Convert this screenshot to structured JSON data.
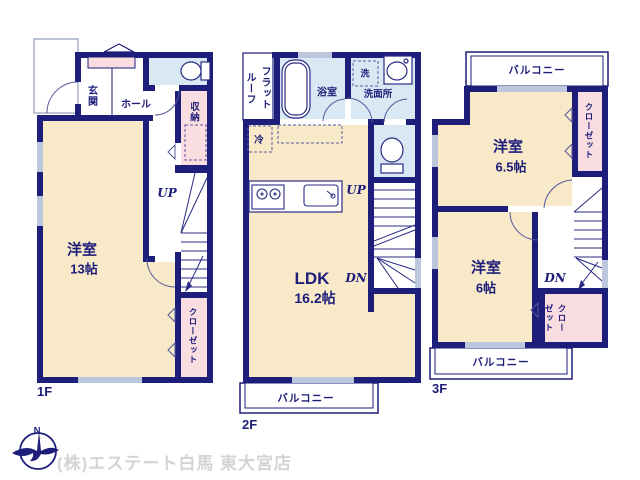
{
  "floor1": {
    "label": "1F",
    "entrance": "玄関",
    "hall": "ホール",
    "storage": "収納",
    "stairs_up": "UP",
    "room": "洋室",
    "room_size": "13帖",
    "closet": "クローゼット"
  },
  "floor2": {
    "label": "2F",
    "flat_roof": "フラットルーフ",
    "bath": "浴室",
    "laundry": "洗",
    "washroom": "洗面所",
    "fridge": "冷",
    "ldk": "LDK",
    "ldk_size": "16.2帖",
    "stairs_up": "UP",
    "stairs_down": "DN",
    "balcony": "バルコニー"
  },
  "floor3": {
    "label": "3F",
    "balcony_top": "バルコニー",
    "room1": "洋室",
    "room1_size": "6.5帖",
    "closet1": "クローゼット",
    "room2": "洋室",
    "room2_size": "6帖",
    "closet2": "クローゼット",
    "stairs_down": "DN",
    "balcony_bottom": "バルコニー"
  },
  "footer": {
    "company": "(株)エステート白馬 東大宮店",
    "compass_north": "N"
  },
  "colors": {
    "wall_navy": "#1d1d7a",
    "room_cream": "#f8e9c8",
    "wet_area_blue": "#d9e9f4",
    "closet_pink": "#f9dde1",
    "window_gray": "#bcc7de",
    "watermark_gray": "#d4d4d4"
  }
}
